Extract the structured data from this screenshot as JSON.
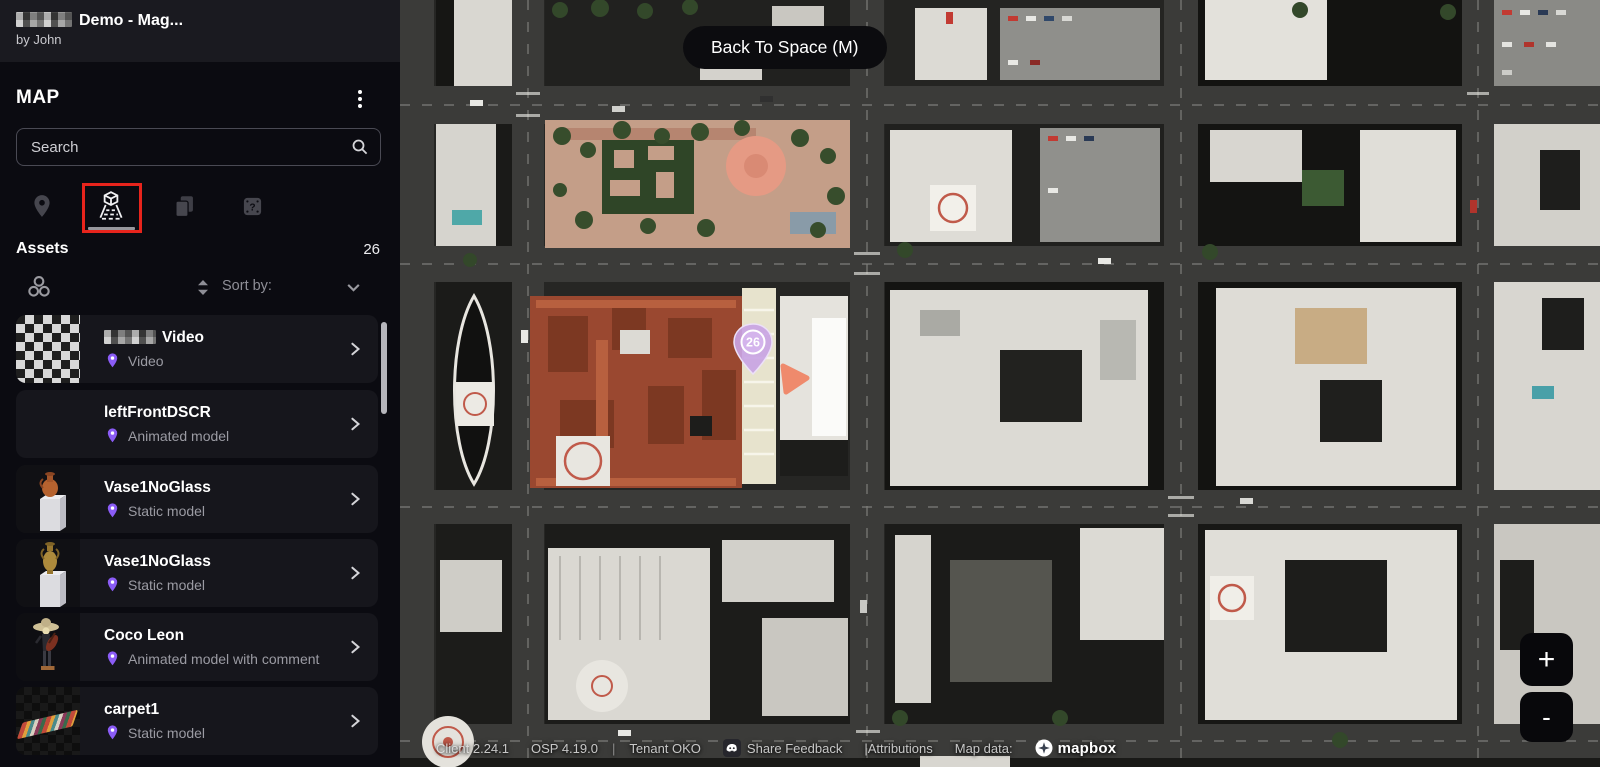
{
  "header": {
    "title": "Demo - Mag...",
    "subtitle": "by John"
  },
  "panel": {
    "title": "MAP",
    "search_placeholder": "Search",
    "assets_label": "Assets",
    "assets_count": "26",
    "sort_label": "Sort by:",
    "tabs": [
      {
        "name": "locations",
        "active": false
      },
      {
        "name": "assets-3d",
        "active": true
      },
      {
        "name": "copies",
        "active": false
      },
      {
        "name": "help",
        "active": false
      }
    ]
  },
  "assets": [
    {
      "title": "Video",
      "type": "Video",
      "censored_prefix": true
    },
    {
      "title": "leftFrontDSCR",
      "type": "Animated model"
    },
    {
      "title": "Vase1NoGlass",
      "type": "Static model"
    },
    {
      "title": "Vase1NoGlass",
      "type": "Static model"
    },
    {
      "title": "Coco Leon",
      "type": "Animated model with comment"
    },
    {
      "title": "carpet1",
      "type": "Static model"
    }
  ],
  "map": {
    "back_button": "Back To Space (M)",
    "marker_count": "26",
    "zoom_in": "+",
    "zoom_out": "-",
    "attribution": {
      "client": "Client 2.24.1",
      "osp": "OSP 4.19.0",
      "tenant": "Tenant OKO",
      "feedback": "Share Feedback",
      "attributions": "|Attributions",
      "map_data": "Map data:",
      "provider": "mapbox"
    }
  },
  "colors": {
    "accent_purple": "#8b5cf6",
    "highlight_red": "#e8241c",
    "marker_purple": "#c9a4e4",
    "marker_orange": "#ef8a6c"
  }
}
